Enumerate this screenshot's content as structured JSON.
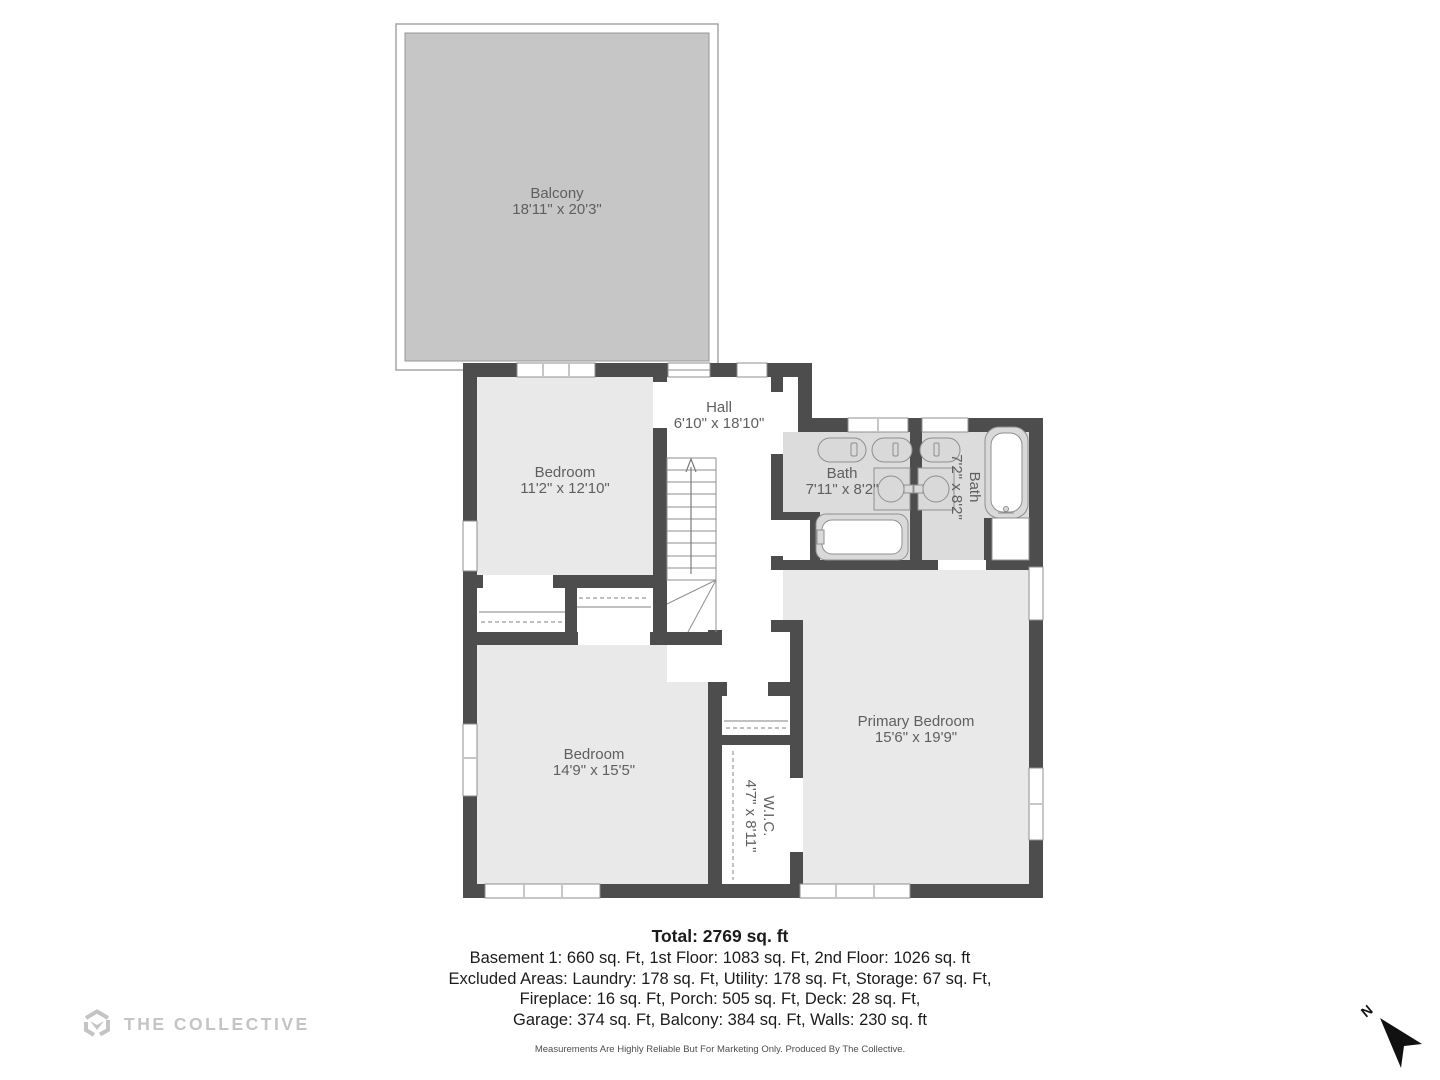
{
  "floorplan": {
    "rooms": [
      {
        "id": "balcony",
        "label": "Balcony",
        "dims": "18'11\" x 20'3\""
      },
      {
        "id": "bedroom1",
        "label": "Bedroom",
        "dims": "11'2\" x 12'10\""
      },
      {
        "id": "hall",
        "label": "Hall",
        "dims": "6'10\" x 18'10\""
      },
      {
        "id": "bath1",
        "label": "Bath",
        "dims": "7'11\" x 8'2\""
      },
      {
        "id": "bath2",
        "label": "Bath",
        "dims": "7'2\" x 8'2\"",
        "rotated": true
      },
      {
        "id": "primary_bedroom",
        "label": "Primary Bedroom",
        "dims": "15'6\" x 19'9\""
      },
      {
        "id": "bedroom2",
        "label": "Bedroom",
        "dims": "14'9\" x 15'5\""
      },
      {
        "id": "wic",
        "label": "W.I.C.",
        "dims": "4'7\" x 8'11\"",
        "rotated": true
      }
    ],
    "north_label": "N"
  },
  "summary": {
    "total": "Total: 2769 sq. ft",
    "line1": "Basement 1: 660 sq. Ft, 1st Floor: 1083 sq. Ft, 2nd Floor: 1026 sq. ft",
    "line2": "Excluded Areas: Laundry: 178 sq. Ft, Utility: 178 sq. Ft, Storage: 67 sq. Ft,",
    "line3": "Fireplace: 16 sq. Ft, Porch: 505 sq. Ft, Deck: 28 sq. Ft,",
    "line4": "Garage: 374 sq. Ft, Balcony: 384 sq. Ft, Walls: 230 sq. ft"
  },
  "footer": {
    "brand": "THE COLLECTIVE",
    "disclaimer": "Measurements Are Highly Reliable But For Marketing Only. Produced By The Collective."
  },
  "colors": {
    "wall": "#4d4d4d",
    "bedroom_fill": "#e9e9e9",
    "bath_fill": "#dcdcdc",
    "balcony_fill": "#c6c6c6",
    "fixture_fill": "#d9d9d9",
    "outline": "#8f8f8f",
    "label": "#5f5f5f",
    "brand": "#c4c4c4",
    "north": "#111111"
  }
}
